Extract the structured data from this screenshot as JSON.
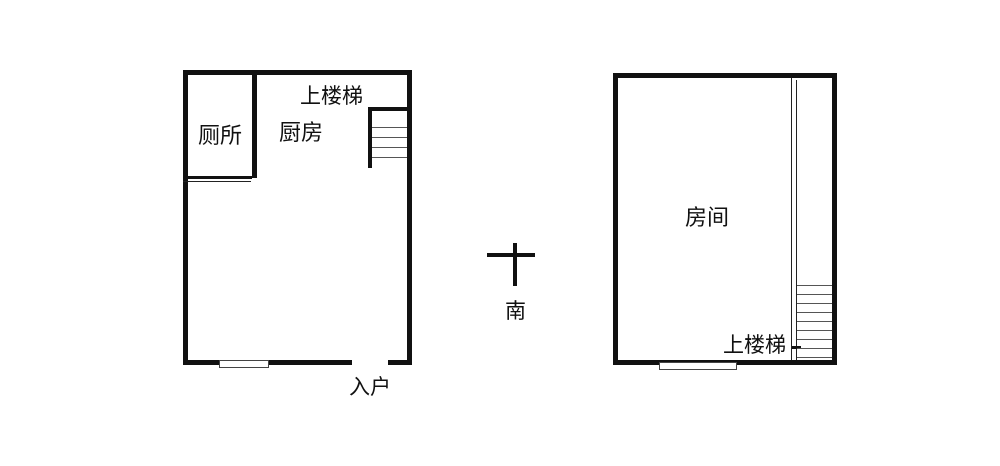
{
  "page": {
    "background": "#ffffff",
    "line_color": "#111111",
    "description": "Two-level apartment floor plan sketch"
  },
  "left_plan": {
    "labels": {
      "toilet": "厕所",
      "stairs_up": "上楼梯",
      "kitchen": "厨房",
      "entrance": "入户"
    }
  },
  "compass": {
    "symbol": "cross",
    "south": "南"
  },
  "right_plan": {
    "labels": {
      "room": "房间",
      "stairs_up": "上楼梯"
    }
  }
}
